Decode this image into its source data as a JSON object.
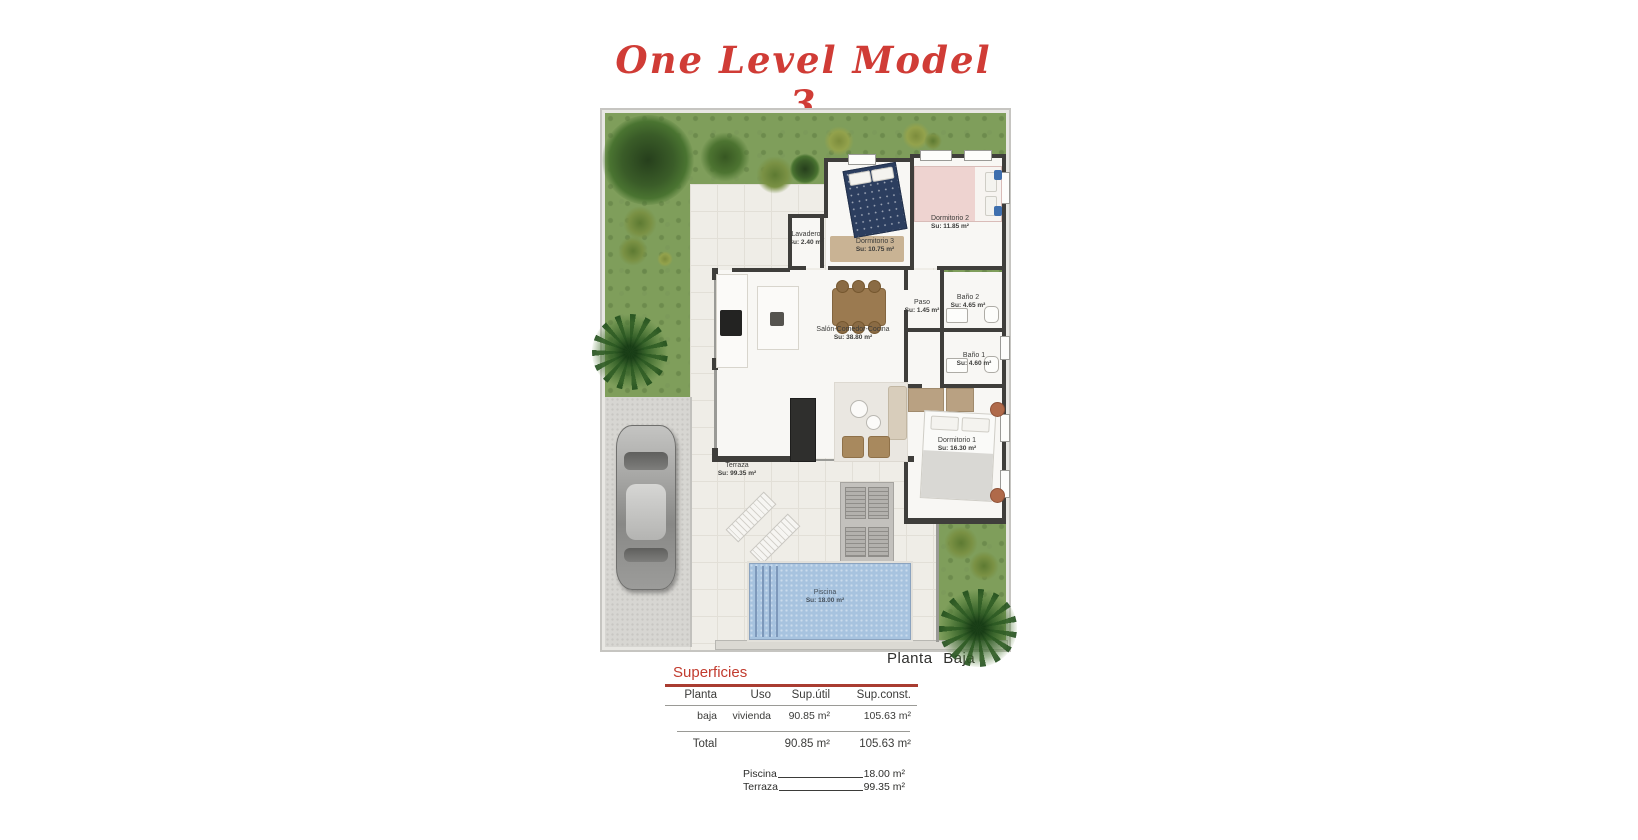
{
  "title": "One Level Model 3",
  "plan": {
    "caption": "Planta Baja",
    "rooms": [
      {
        "name": "Lavadero",
        "area": "Su: 2.40 m²"
      },
      {
        "name": "Dormitorio 3",
        "area": "Su: 10.75 m²"
      },
      {
        "name": "Dormitorio 2",
        "area": "Su: 11.85 m²"
      },
      {
        "name": "Paso",
        "area": "Su: 1.45 m²"
      },
      {
        "name": "Baño 2",
        "area": "Su: 4.65 m²"
      },
      {
        "name": "Salón-Comedor-Cocina",
        "area": "Su: 38.80 m²"
      },
      {
        "name": "Baño 1",
        "area": "Su: 4.60 m²"
      },
      {
        "name": "Dormitorio 1",
        "area": "Su: 16.30 m²"
      },
      {
        "name": "Terraza",
        "area": "Su: 99.35 m²"
      },
      {
        "name": "Piscina",
        "area": "Su: 18.00 m²"
      }
    ]
  },
  "surfaces_table": {
    "section_title": "Superficies",
    "headers": [
      "Planta",
      "Uso",
      "Sup.útil",
      "Sup.const."
    ],
    "row": {
      "planta": "baja",
      "uso": "vivienda",
      "sup_util": "90.85 m²",
      "sup_const": "105.63 m²"
    },
    "total": {
      "label": "Total",
      "sup_util": "90.85 m²",
      "sup_const": "105.63 m²"
    },
    "extras": [
      {
        "label": "Piscina",
        "value": "18.00 m²"
      },
      {
        "label": "Terraza",
        "value": "99.35 m²"
      }
    ]
  },
  "colors": {
    "accent_red": "#c23b2e",
    "grass_green": "#7f9e5b",
    "pool_blue": "#a7c3df",
    "wall_dark": "#3f3e3b"
  }
}
